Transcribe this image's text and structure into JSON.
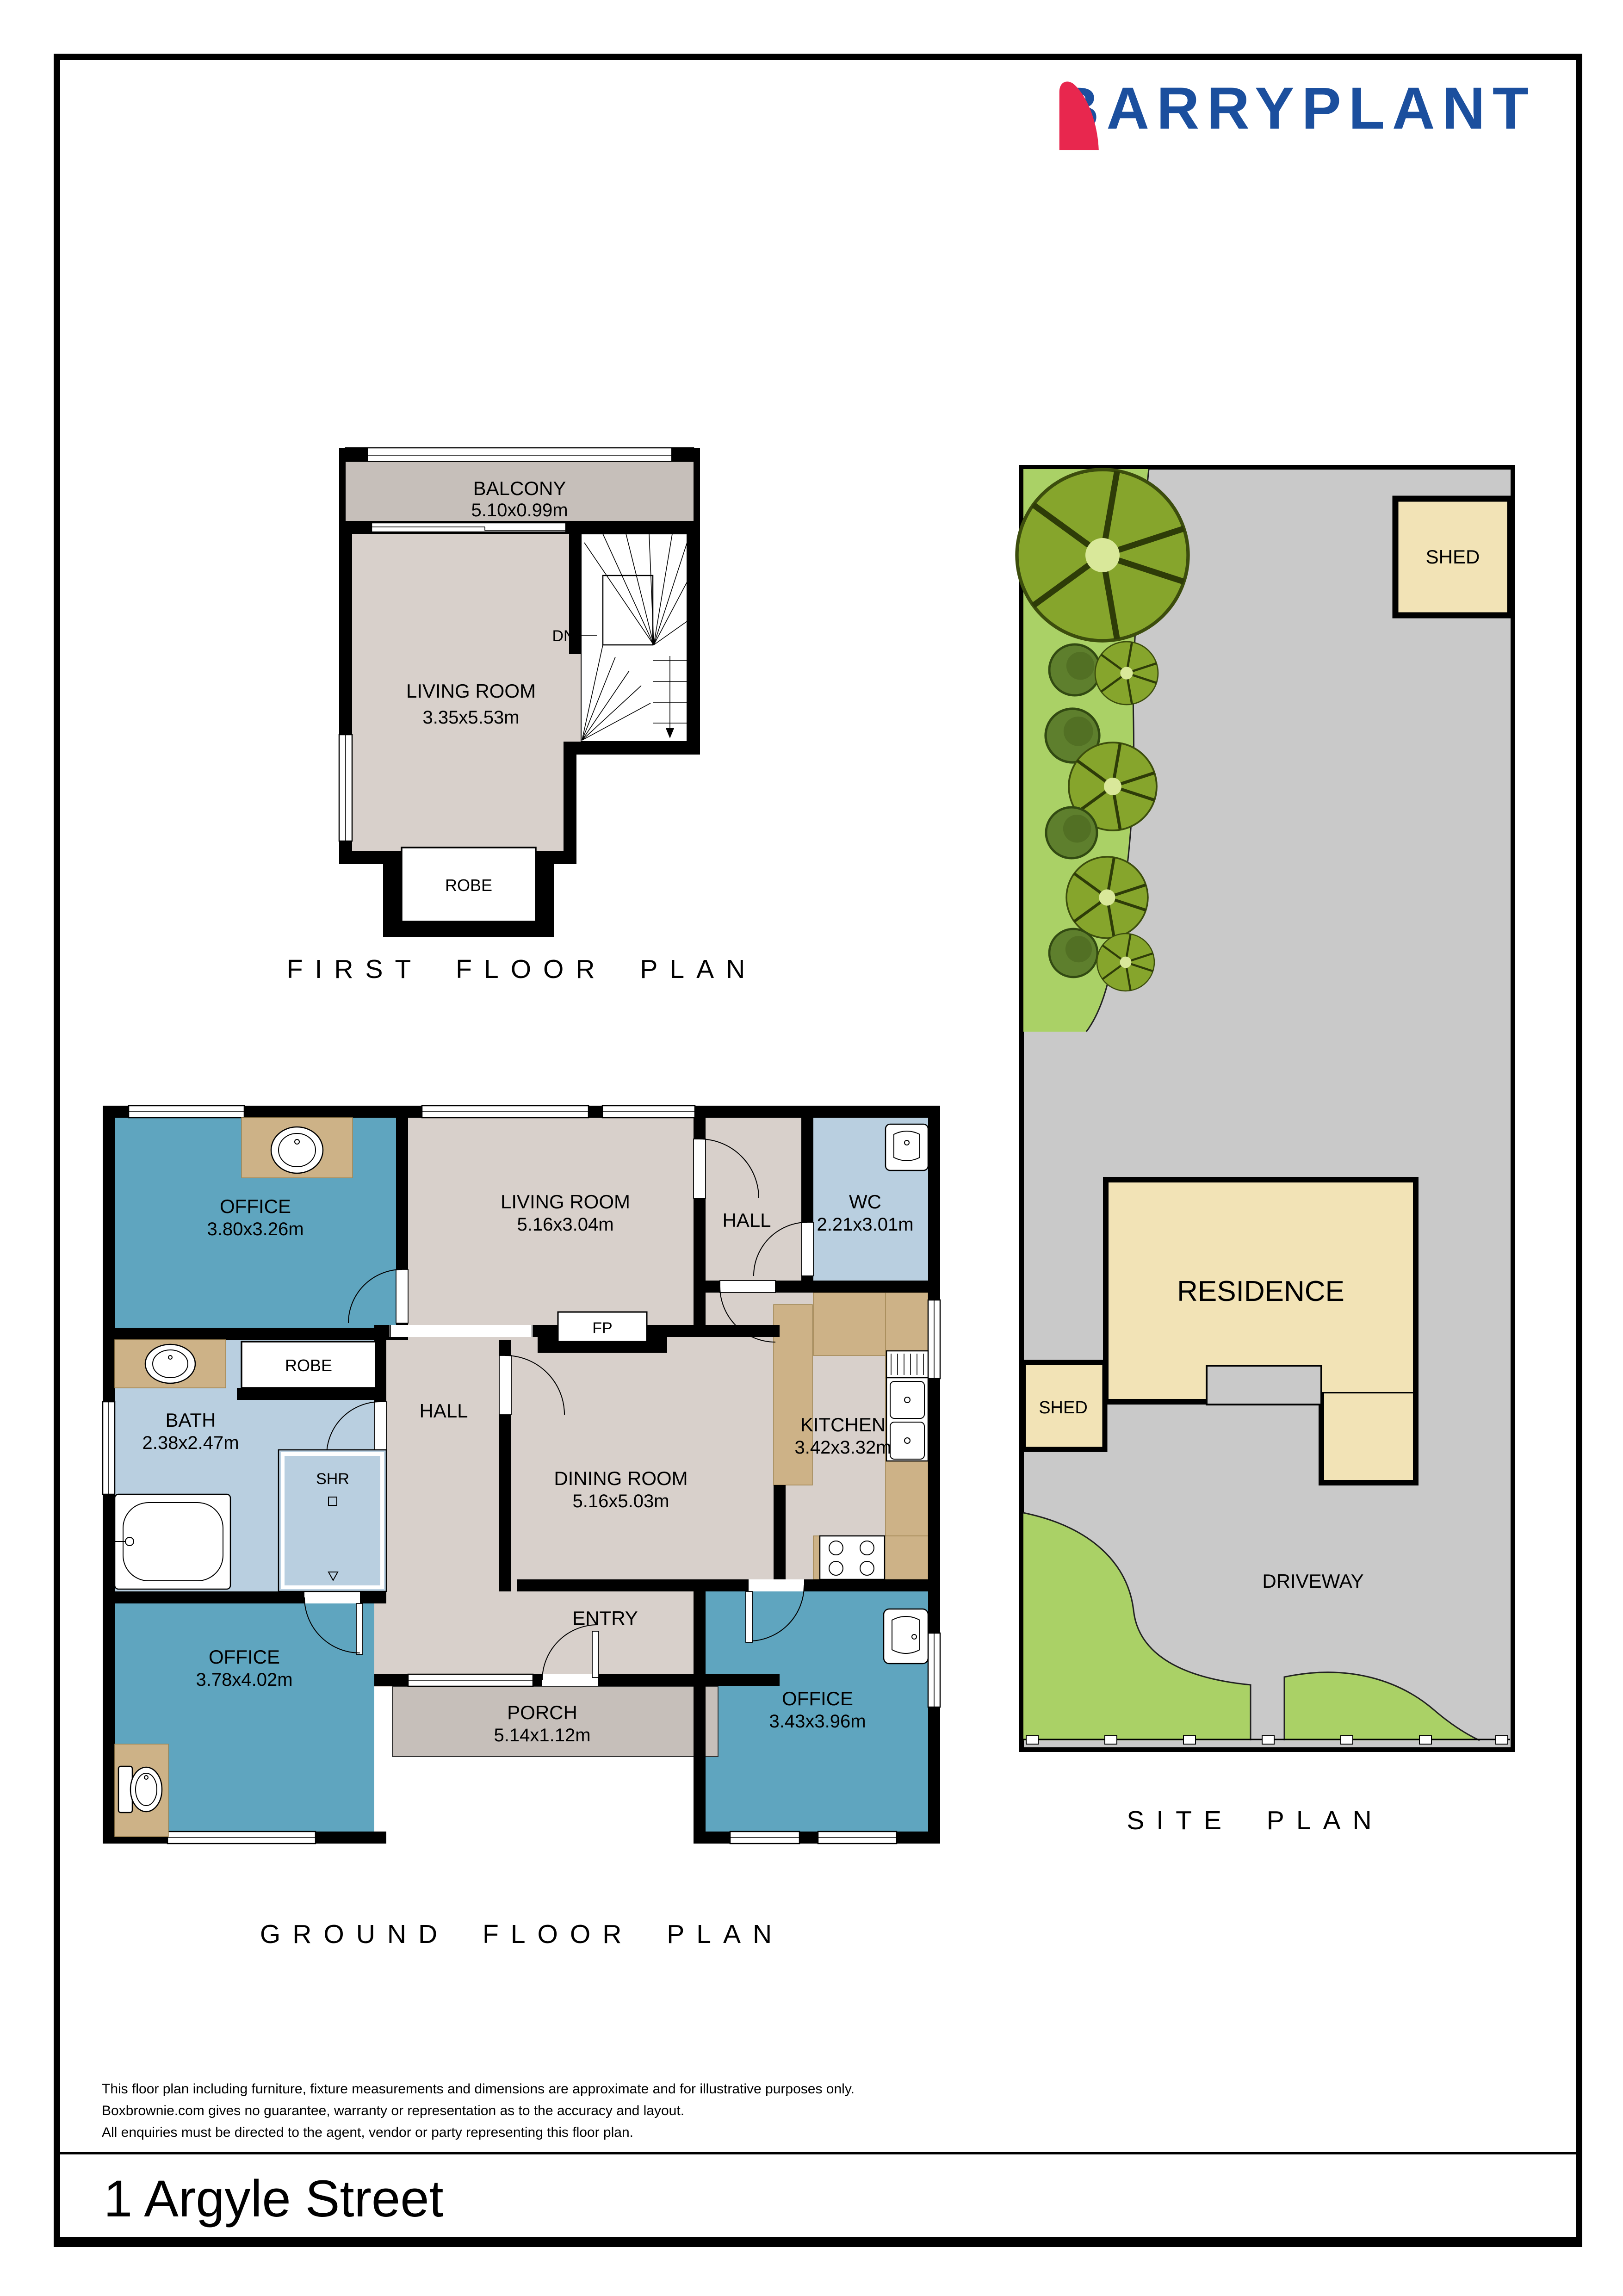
{
  "brand": {
    "name": "BARRYPLANT"
  },
  "colors": {
    "logo_blue": "#1b4f9e",
    "logo_red": "#e8274e",
    "room_teal": "#5fa5bf",
    "room_beige": "#d8d0cb",
    "room_blue": "#b9cfe0",
    "floor_grey": "#c6bfba",
    "site_grey": "#c9c9c9",
    "lawn_green": "#aad166",
    "building_tan": "#f2e3b6"
  },
  "floors": {
    "first": {
      "title": "FIRST FLOOR PLAN",
      "balcony_name": "BALCONY",
      "balcony_dims": "5.10x0.99m",
      "living_name": "LIVING ROOM",
      "living_dims": "3.35x5.53m",
      "dn": "DN",
      "robe": "ROBE"
    },
    "ground": {
      "title": "GROUND FLOOR PLAN",
      "office_nw_name": "OFFICE",
      "office_nw_dims": "3.80x3.26m",
      "living_name": "LIVING ROOM",
      "living_dims": "5.16x3.04m",
      "hall_upper": "HALL",
      "wc_name": "WC",
      "wc_dims": "2.21x3.01m",
      "robe": "ROBE",
      "bath_name": "BATH",
      "bath_dims": "2.38x2.47m",
      "shr": "SHR",
      "hall_central": "HALL",
      "fp": "FP",
      "dining_name": "DINING ROOM",
      "dining_dims": "5.16x5.03m",
      "kitchen_name": "KITCHEN",
      "kitchen_dims": "3.42x3.32m",
      "entry": "ENTRY",
      "office_sw_name": "OFFICE",
      "office_sw_dims": "3.78x4.02m",
      "office_se_name": "OFFICE",
      "office_se_dims": "3.43x3.96m",
      "porch_name": "PORCH",
      "porch_dims": "5.14x1.12m"
    },
    "site": {
      "title": "SITE PLAN",
      "shed_top": "SHED",
      "shed_left": "SHED",
      "residence": "RESIDENCE",
      "driveway": "DRIVEWAY"
    }
  },
  "disclaimer": {
    "line1": "This floor plan including furniture, fixture measurements and dimensions are approximate and for illustrative purposes only.",
    "line2": "Boxbrownie.com gives no guarantee, warranty or representation as to the accuracy and layout.",
    "line3": "All enquiries must be directed to the agent, vendor or party representing this floor plan."
  },
  "address": "1 Argyle Street"
}
